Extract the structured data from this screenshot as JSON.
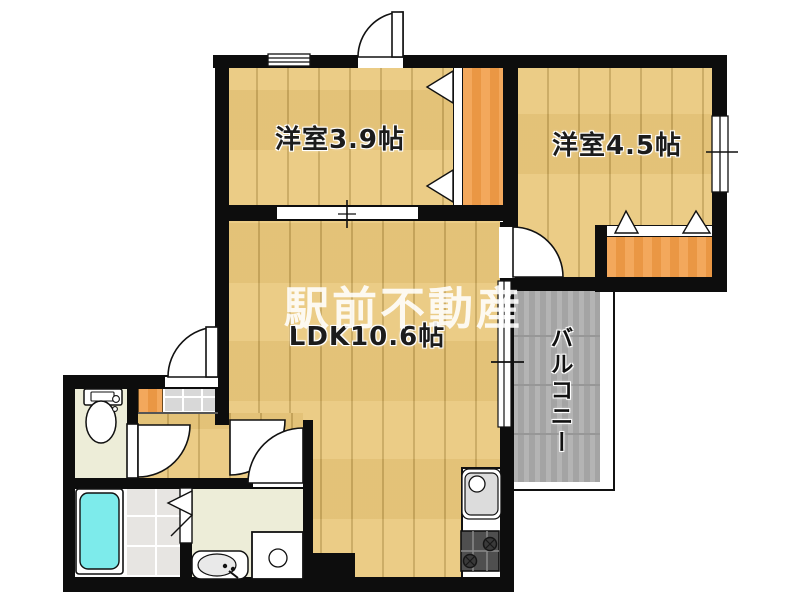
{
  "watermark": "駅前不動産",
  "rooms": {
    "western_room_1": "洋室3.9帖",
    "western_room_2": "洋室4.5帖",
    "ldk": "LDK10.6帖",
    "balcony": "バルコニー"
  },
  "colors": {
    "wall": "#0d0d0d",
    "wood": "#eac97e",
    "wood_seam": "#c9a85e",
    "closet": "#f29e4a",
    "balcony": "#aeaeae",
    "balcony_line": "#979797",
    "bath_tile": "#e7e5e2",
    "genkan_tile": "#d8d8d8",
    "pale": "#ededd8",
    "tub": "#7debeb"
  }
}
